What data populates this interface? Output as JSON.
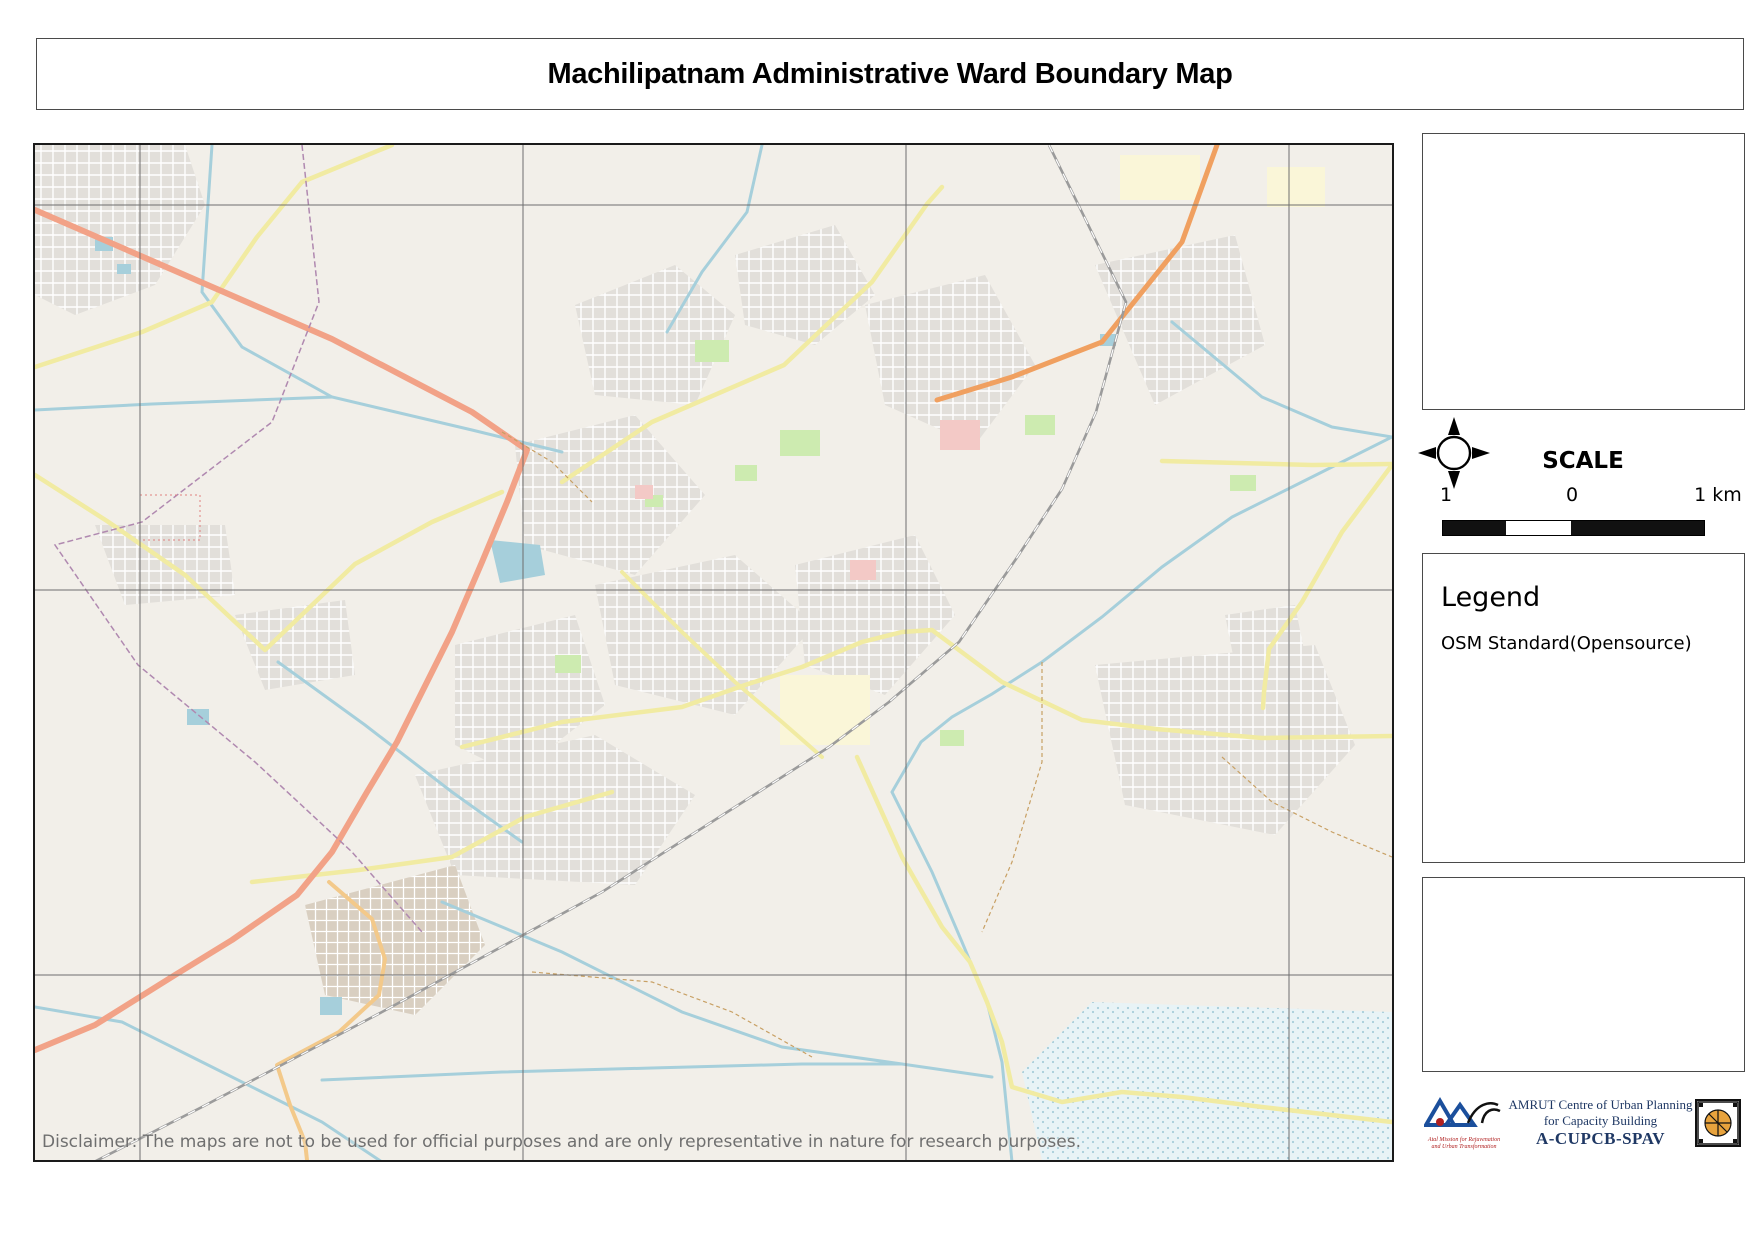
{
  "title": "Machilipatnam Administrative Ward Boundary Map",
  "colors": {
    "municipal_boundary": "#0d0d0d",
    "ward_boundary": "#bf0a1e",
    "map_bg": "#f2efe9",
    "water": "#a6cfdb",
    "grid": "#6e6e6e",
    "credit_navy": "#1f3864"
  },
  "frame": {
    "lon_labels": [
      {
        "t": "81.088",
        "x": 140
      },
      {
        "t": "81.116",
        "x": 521
      },
      {
        "t": "81.144",
        "x": 904
      },
      {
        "t": "81.172",
        "x": 1287
      }
    ],
    "lat_labels": [
      {
        "t": "16.212",
        "y": 203
      },
      {
        "t": "16.184",
        "y": 588
      },
      {
        "t": "16.156",
        "y": 973
      }
    ]
  },
  "map": {
    "disclaimer": "Disclaimer: The maps are not to be used for official purposes and are only representative in nature for research purposes.",
    "wards": [
      {
        "n": 1,
        "x": 772,
        "y": 166
      },
      {
        "n": 2,
        "x": 841,
        "y": 253
      },
      {
        "n": 3,
        "x": 896,
        "y": 166
      },
      {
        "n": 4,
        "x": 947,
        "y": 241
      },
      {
        "n": 5,
        "x": 1079,
        "y": 247
      },
      {
        "n": 6,
        "x": 966,
        "y": 301
      },
      {
        "n": 7,
        "x": 1118,
        "y": 388
      },
      {
        "n": 8,
        "x": 1060,
        "y": 461
      },
      {
        "n": 9,
        "x": 954,
        "y": 365
      },
      {
        "n": 10,
        "x": 880,
        "y": 395
      },
      {
        "n": 11,
        "x": 1008,
        "y": 541
      },
      {
        "n": 12,
        "x": 896,
        "y": 523
      },
      {
        "n": 13,
        "x": 843,
        "y": 501
      },
      {
        "n": 14,
        "x": 827,
        "y": 421
      },
      {
        "n": 15,
        "x": 787,
        "y": 451
      },
      {
        "n": 16,
        "x": 761,
        "y": 475
      },
      {
        "n": 17,
        "x": 708,
        "y": 487
      },
      {
        "n": 18,
        "x": 749,
        "y": 545
      },
      {
        "n": 19,
        "x": 823,
        "y": 587
      },
      {
        "n": 20,
        "x": 1120,
        "y": 981
      },
      {
        "n": 21,
        "x": 949,
        "y": 873
      },
      {
        "n": 22,
        "x": 747,
        "y": 616
      },
      {
        "n": 23,
        "x": 703,
        "y": 664
      },
      {
        "n": 24,
        "x": 713,
        "y": 564
      },
      {
        "n": 25,
        "x": 670,
        "y": 613
      },
      {
        "n": 26,
        "x": 664,
        "y": 554
      },
      {
        "n": 27,
        "x": 619,
        "y": 609
      },
      {
        "n": 28,
        "x": 615,
        "y": 682
      },
      {
        "n": 29,
        "x": 546,
        "y": 718
      },
      {
        "n": 30,
        "x": 424,
        "y": 742
      },
      {
        "n": 31,
        "x": 331,
        "y": 812
      },
      {
        "n": 32,
        "x": 454,
        "y": 638
      },
      {
        "n": 33,
        "x": 561,
        "y": 621
      },
      {
        "n": 34,
        "x": 496,
        "y": 567
      },
      {
        "n": 35,
        "x": 598,
        "y": 561
      },
      {
        "n": 36,
        "x": 518,
        "y": 511
      },
      {
        "n": 37,
        "x": 596,
        "y": 514
      },
      {
        "n": 38,
        "x": 649,
        "y": 518
      },
      {
        "n": 39,
        "x": 562,
        "y": 452
      },
      {
        "n": 40,
        "x": 607,
        "y": 436
      },
      {
        "n": 41,
        "x": 562,
        "y": 362
      },
      {
        "n": 42,
        "x": 625,
        "y": 351
      },
      {
        "n": 43,
        "x": 637,
        "y": 400
      },
      {
        "n": 44,
        "x": 725,
        "y": 428
      },
      {
        "n": 45,
        "x": 781,
        "y": 378
      },
      {
        "n": 46,
        "x": 768,
        "y": 285
      },
      {
        "n": 47,
        "x": 710,
        "y": 347
      },
      {
        "n": 48,
        "x": 690,
        "y": 379
      },
      {
        "n": 49,
        "x": 676,
        "y": 322
      },
      {
        "n": 50,
        "x": 656,
        "y": 267
      }
    ],
    "place_labels": [
      {
        "t": "Gudur",
        "x": 34,
        "y": 10,
        "cls": ""
      },
      {
        "t": "Kokanarayanapalem",
        "x": 297,
        "y": 20,
        "cls": ""
      },
      {
        "t": "Pothepalle",
        "x": 932,
        "y": 16,
        "cls": ""
      },
      {
        "t": "Ullipalem",
        "x": 989,
        "y": 141,
        "cls": ""
      },
      {
        "t": "Srinivasa Nagar",
        "x": 1237,
        "y": 119,
        "cls": ""
      },
      {
        "t": "Machavaram",
        "x": 1332,
        "y": 115,
        "cls": ""
      },
      {
        "t": "SRH College of Engineering",
        "x": 1240,
        "y": 42,
        "cls": "pl-tiny"
      },
      {
        "t": "Arisepalle",
        "x": 549,
        "y": 113,
        "cls": ""
      },
      {
        "t": "Ramarajupalem",
        "x": 100,
        "y": 162,
        "cls": ""
      },
      {
        "t": "Sultannagaram",
        "x": 339,
        "y": 300,
        "cls": ""
      },
      {
        "t": "Gollapalem",
        "x": 339,
        "y": 314,
        "cls": ""
      },
      {
        "t": "Sitarampuram",
        "x": 105,
        "y": 409,
        "cls": ""
      },
      {
        "t": "B.V.Thota",
        "x": 238,
        "y": 494,
        "cls": ""
      },
      {
        "t": "Gudupeta",
        "x": 470,
        "y": 503,
        "cls": ""
      },
      {
        "t": "Rajupeta",
        "x": 556,
        "y": 563,
        "cls": ""
      },
      {
        "t": "Ullankapalem",
        "x": 700,
        "y": 675,
        "cls": ""
      },
      {
        "t": "Kara Agraharam",
        "x": 1228,
        "y": 563,
        "cls": ""
      },
      {
        "t": "Pedda Karampeda",
        "x": 1190,
        "y": 608,
        "cls": ""
      },
      {
        "t": "Baba Nagar",
        "x": 1253,
        "y": 498,
        "cls": "pl-tiny"
      },
      {
        "t": "Bhardapuram",
        "x": 427,
        "y": 733,
        "cls": ""
      },
      {
        "t": "Kalekhanpet",
        "x": 322,
        "y": 787,
        "cls": "pl-tiny"
      },
      {
        "t": "Maddepalli",
        "x": 310,
        "y": 800,
        "cls": ""
      },
      {
        "t": "Krishnalaopeta",
        "x": 42,
        "y": 695,
        "cls": ""
      },
      {
        "t": "Rudravaram",
        "x": 62,
        "y": 775,
        "cls": ""
      },
      {
        "t": "Gollapalem",
        "x": 42,
        "y": 850,
        "cls": ""
      },
      {
        "t": "Bandarkota",
        "x": 956,
        "y": 860,
        "cls": ""
      },
      {
        "t": "( Bandar Fort )",
        "x": 956,
        "y": 874,
        "cls": ""
      },
      {
        "t": "Kota Fort",
        "x": 945,
        "y": 888,
        "cls": "pl-tiny"
      },
      {
        "t": "Gilakaladindi",
        "x": 1129,
        "y": 991,
        "cls": ""
      },
      {
        "t": "New Railway Station",
        "x": 862,
        "y": 594,
        "cls": "pl-station"
      },
      {
        "t": "Machilipatnam",
        "x": 774,
        "y": 631,
        "cls": "pl-station"
      },
      {
        "t": "Chilakalapudi",
        "x": 1063,
        "y": 223,
        "cls": ""
      },
      {
        "t": "Chilakalapudi",
        "x": 1102,
        "y": 207,
        "cls": "pl-station"
      },
      {
        "t": "Vijayawada - Machilipatnam Road",
        "x": 190,
        "y": 148,
        "cls": "pl-road",
        "rot": 23
      },
      {
        "t": "Machilipatnam Main Road",
        "x": 427,
        "y": 722,
        "cls": "pl-road",
        "rot": -7
      },
      {
        "t": "Harbour Road",
        "x": 1150,
        "y": 950,
        "cls": "pl-road",
        "rot": 4
      },
      {
        "t": "Machilipatnam",
        "x": 66,
        "y": 452,
        "cls": "pl-admin",
        "rot": 73
      }
    ],
    "road_badges": [
      {
        "t": "NH65",
        "x": 120,
        "y": 119
      },
      {
        "t": "NH216",
        "x": 424,
        "y": 337
      },
      {
        "t": "MDR",
        "x": 72,
        "y": 376
      },
      {
        "t": "MDR",
        "x": 751,
        "y": 215
      },
      {
        "t": "MDR",
        "x": 387,
        "y": 525
      },
      {
        "t": "MDR",
        "x": 1142,
        "y": 316
      },
      {
        "t": "MDR",
        "x": 1292,
        "y": 595
      },
      {
        "t": "MDR",
        "x": 976,
        "y": 900
      },
      {
        "t": "MDR",
        "x": 1319,
        "y": 1003
      },
      {
        "t": "SH338",
        "x": 346,
        "y": 768
      },
      {
        "t": "SH340",
        "x": 332,
        "y": 855
      },
      {
        "t": "NH216",
        "x": 294,
        "y": 740
      }
    ]
  },
  "sidebar": {
    "project_title_lines": [
      "Project Title:",
      "Urban Blue Green",
      "Infrastructure Toolkit",
      "for Enhanced Resilience",
      "towards Urban Flooding",
      ": The Case of",
      "Machilipatnam",
      "(TUR_24_03)"
    ],
    "compass": {
      "n": "N",
      "e": "E",
      "s": "S",
      "w": "W"
    },
    "scale": {
      "heading": "SCALE",
      "left_label": "1",
      "mid_label": "0",
      "right_label": "1 km"
    },
    "legend": {
      "heading": "Legend",
      "items": [
        {
          "label": "Municipal_boundary",
          "color": "#0d0d0d",
          "type": "solid"
        },
        {
          "label": "Ward boundaries",
          "color": "#bf0a1e",
          "type": "hollow"
        }
      ],
      "note": "OSM Standard(Opensource)"
    },
    "description_lines": [
      "Description of Map:",
      "The map shows the Administrative ward",
      "boundaries within Machilipatnam",
      "municipality.",
      "Source :",
      "Administrative ward boundary map is",
      "developed in QGIS using data sourced",
      "from APSAC webportal."
    ],
    "credits": {
      "amrut_hindi": "अमृत",
      "amrut_sub1": "Atal Mission for Rejuvenation",
      "amrut_sub2": "and Urban Transformation",
      "line1": "AMRUT Centre of Urban Planning",
      "line2": "for Capacity Building",
      "line3": "A-CUPCB-SPAV"
    }
  }
}
